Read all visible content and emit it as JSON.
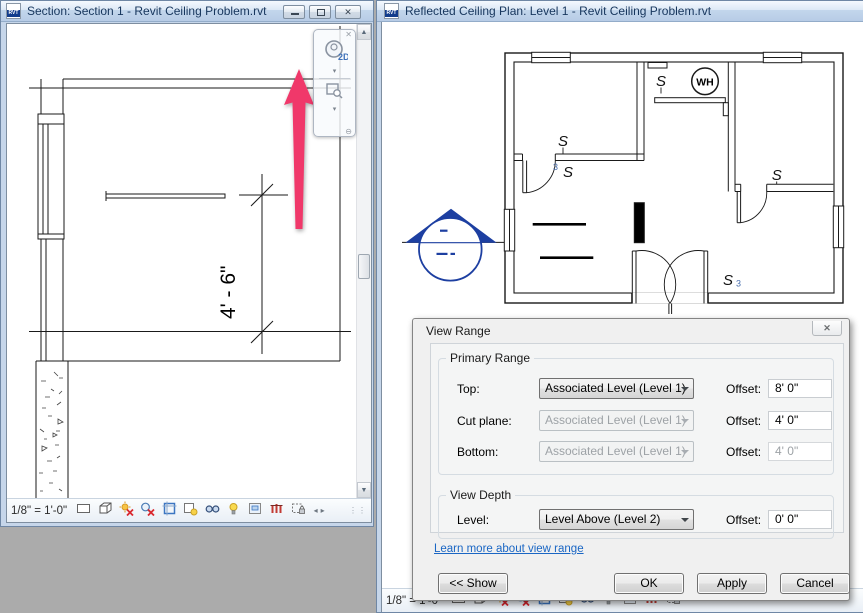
{
  "left_window": {
    "title": "Section: Section 1 - Revit Ceiling Problem.rvt",
    "scale_label": "1/8\" = 1'-0\"",
    "dimension_text": "4' - 6\"",
    "nav_2d_label": "2D",
    "rvt_icon_label": "RVT"
  },
  "right_window": {
    "title": "Reflected Ceiling Plan: Level 1 - Revit Ceiling Problem.rvt",
    "scale_label": "1/8\" = 1'-0\"",
    "rvt_icon_label": "RVT",
    "plan": {
      "water_heater_label": "WH",
      "switch_letter": "S",
      "three_way_label": "3"
    }
  },
  "dialog": {
    "title": "View Range",
    "primary_range": {
      "group_label": "Primary Range",
      "rows": [
        {
          "label": "Top:",
          "value": "Associated Level (Level 1)",
          "offset_label": "Offset:",
          "offset_value": "8' 0\""
        },
        {
          "label": "Cut plane:",
          "value": "Associated Level (Level 1)",
          "offset_label": "Offset:",
          "offset_value": "4' 0\""
        },
        {
          "label": "Bottom:",
          "value": "Associated Level (Level 1)",
          "offset_label": "Offset:",
          "offset_value": "4' 0\""
        }
      ]
    },
    "view_depth": {
      "group_label": "View Depth",
      "level_label": "Level:",
      "level_value": "Level Above (Level 2)",
      "offset_label": "Offset:",
      "offset_value": "0' 0\""
    },
    "link_text": "Learn more about view range",
    "buttons": {
      "show": "<< Show",
      "ok": "OK",
      "apply": "Apply",
      "cancel": "Cancel"
    }
  },
  "colors": {
    "section_marker_blue": "#1D3FA1",
    "annotation_arrow_pink": "#F0386A",
    "titlebar_text": "#17365D",
    "link_blue": "#1A66C4",
    "desktop_gray": "#ABABAB"
  }
}
